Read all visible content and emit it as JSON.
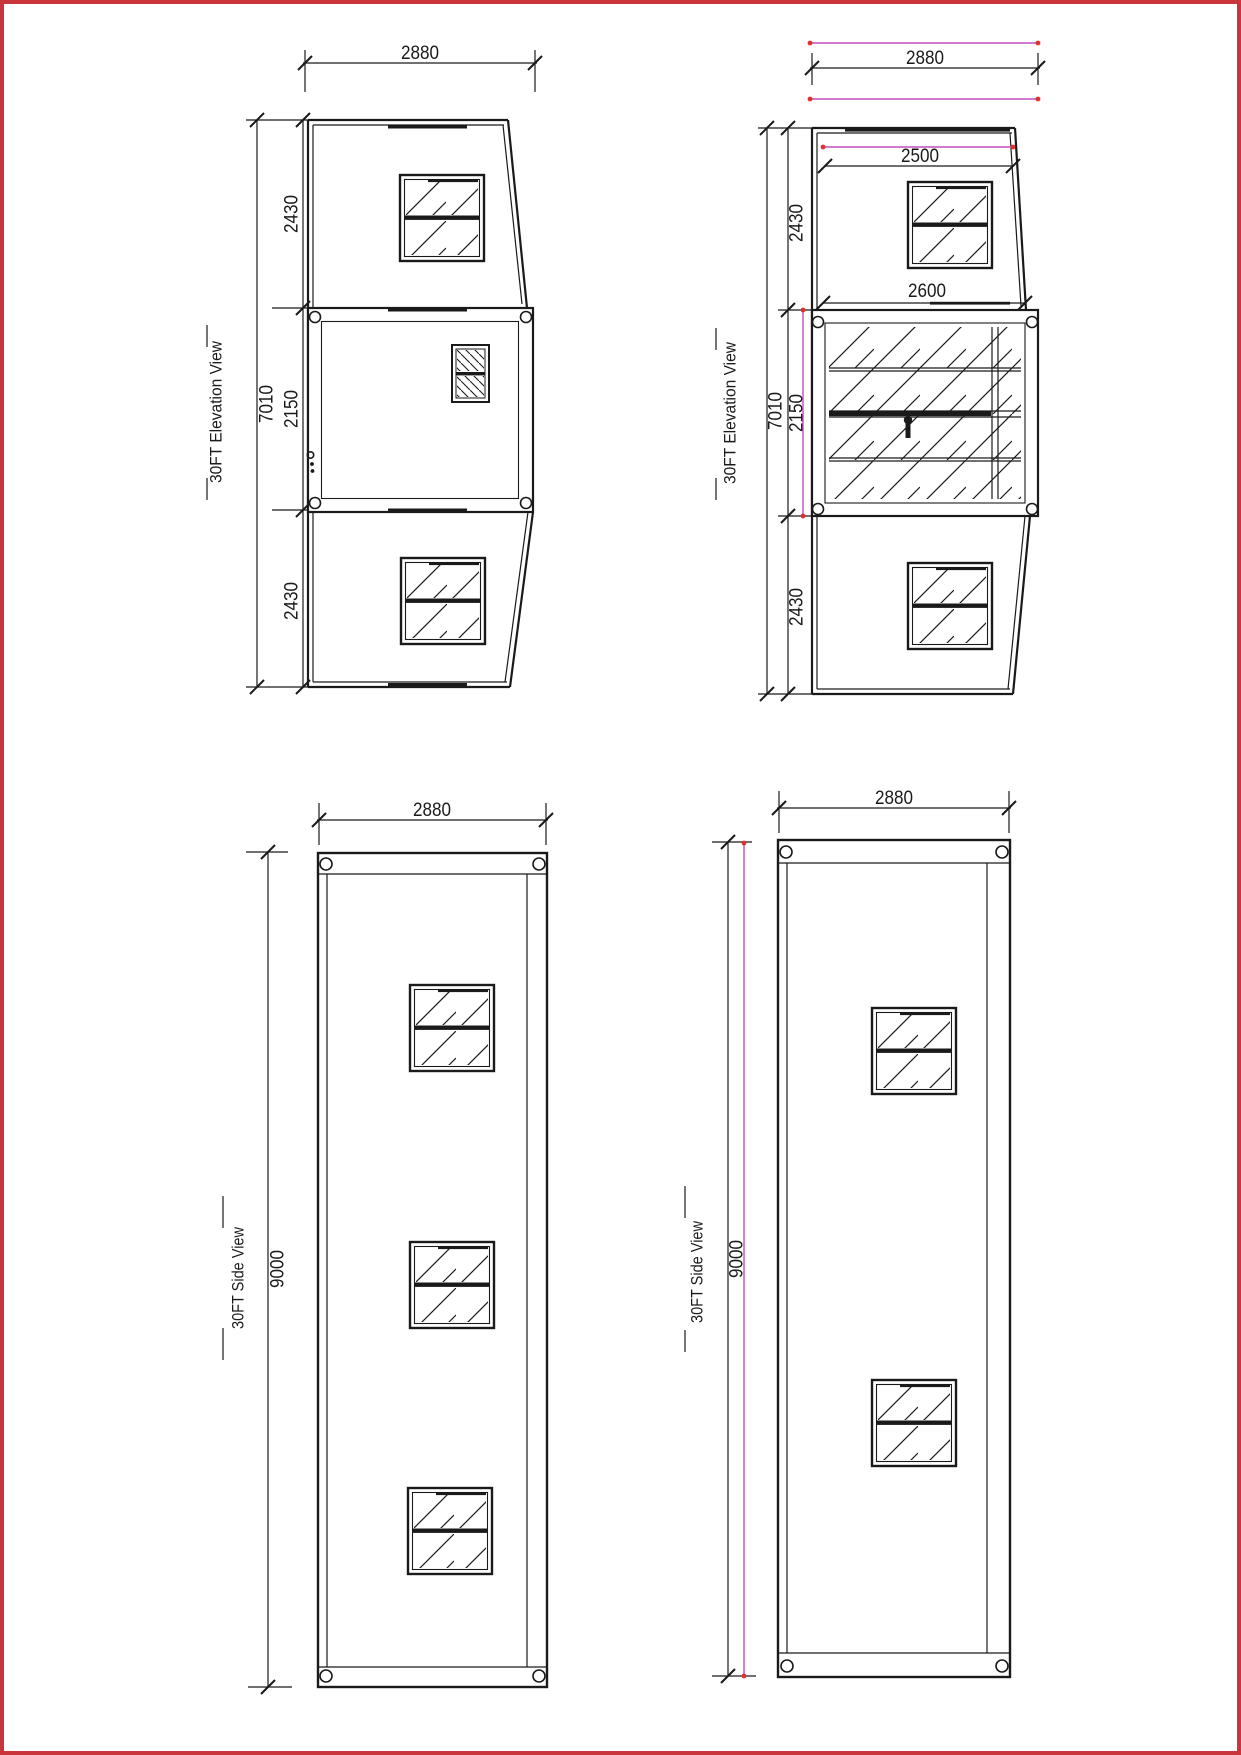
{
  "drawing": {
    "border_color": "#c9353a",
    "line_color": "#1a1a1a",
    "magenta_line_color": "#c24fc2",
    "red_marker_color": "#e03030"
  },
  "views": {
    "elevation_left": {
      "title": "30FT Elevation View",
      "dims": {
        "width": "2880",
        "overall": "7010",
        "upper": "2430",
        "middle": "2150",
        "lower": "2430"
      }
    },
    "elevation_right": {
      "title": "30FT Elevation View",
      "dims": {
        "width": "2880",
        "roof": "2500",
        "floor": "2600",
        "overall": "7010",
        "upper": "2430",
        "middle": "2150",
        "lower": "2430"
      }
    },
    "side_left": {
      "title": "30FT Side View",
      "dims": {
        "width": "2880",
        "length": "9000"
      }
    },
    "side_right": {
      "title": "30FT Side View",
      "dims": {
        "width": "2880",
        "length": "9000"
      }
    }
  }
}
